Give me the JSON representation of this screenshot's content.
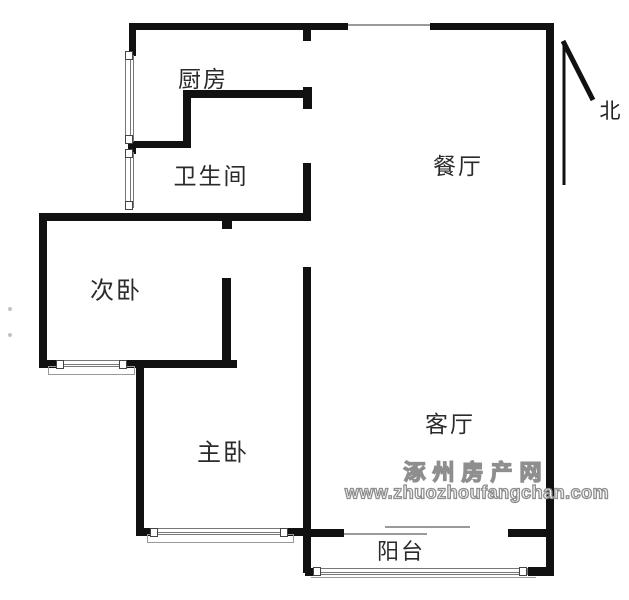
{
  "floorplan": {
    "rooms": {
      "kitchen": "厨房",
      "bathroom": "卫生间",
      "second_bedroom": "次卧",
      "master_bedroom": "主卧",
      "dining_room": "餐厅",
      "living_room": "客厅",
      "balcony": "阳台"
    },
    "compass": {
      "north": "北"
    },
    "watermark": {
      "site_name": "涿州房产网",
      "site_url": "www.zhuozhoufangchan.com"
    },
    "colors": {
      "wall": "#111111",
      "label_text": "#2b2b2b",
      "watermark_gray": "#8e8e8e",
      "window_frame": "#777777"
    }
  }
}
